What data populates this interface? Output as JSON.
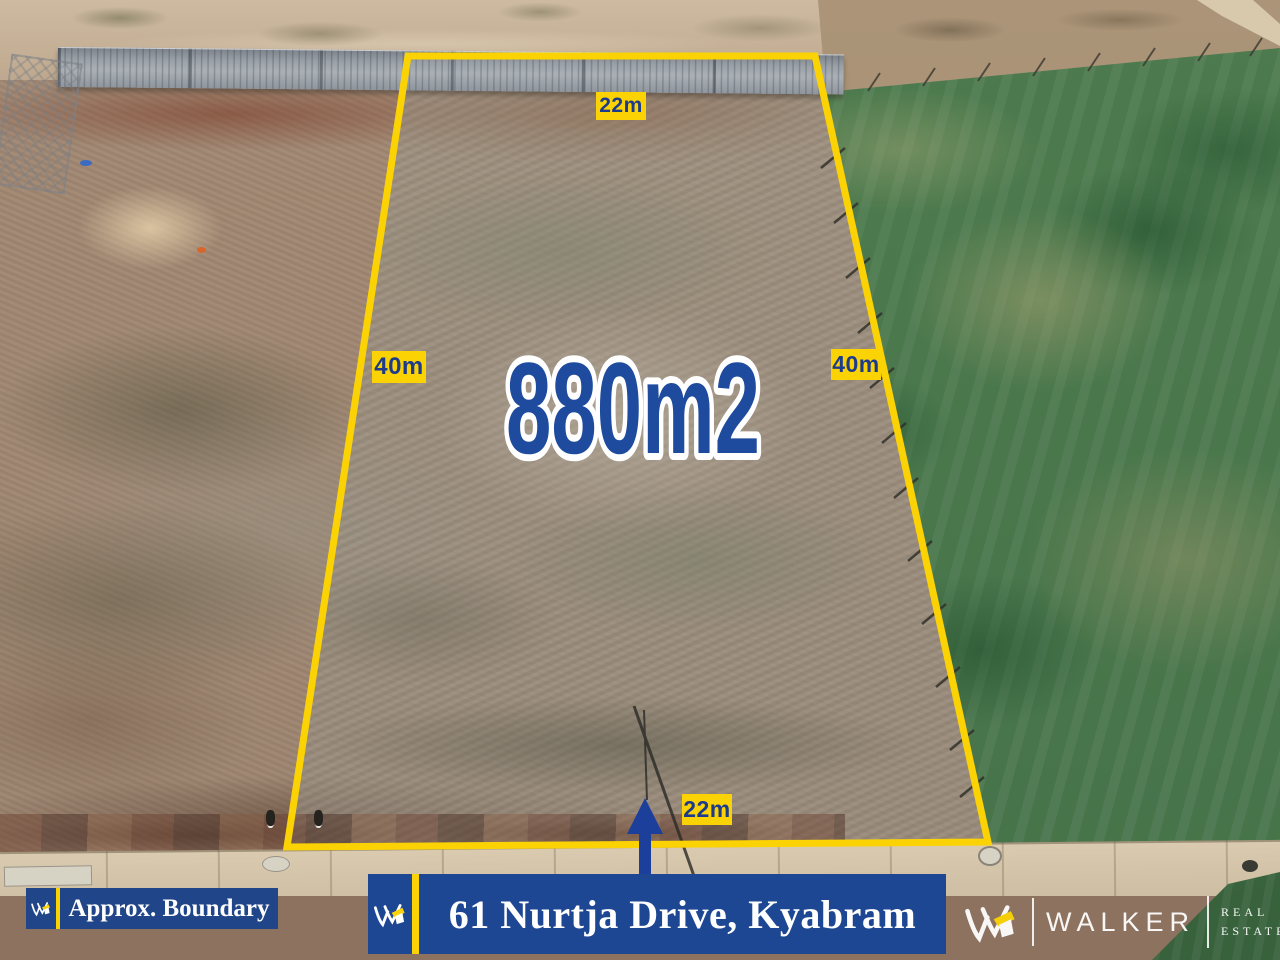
{
  "overlay": {
    "area_label": "880m2",
    "dimension_labels": {
      "top": "22m",
      "left": "40m",
      "right": "40m",
      "bottom": "22m"
    }
  },
  "footer": {
    "approx_boundary_label": "Approx. Boundary",
    "address_banner_label": "61 Nurtja Drive, Kyabram",
    "brand": {
      "name": "WALKER",
      "tagline_line1": "REAL",
      "tagline_line2": "ESTATE"
    }
  },
  "colors": {
    "boundary_yellow": "#FBD304",
    "dimension_label_text_navy": "#1D3B8C",
    "area_text_blue": "#1E4B9E",
    "area_text_outline": "#FFFFFF",
    "arrow_blue": "#1C3F9B",
    "banner_blue": "#1E4793",
    "badge_blue": "#204689",
    "brand_text_white": "#FFFFFF",
    "lawn_green": "#4D7B4E",
    "dirt_tan": "#A18873"
  }
}
